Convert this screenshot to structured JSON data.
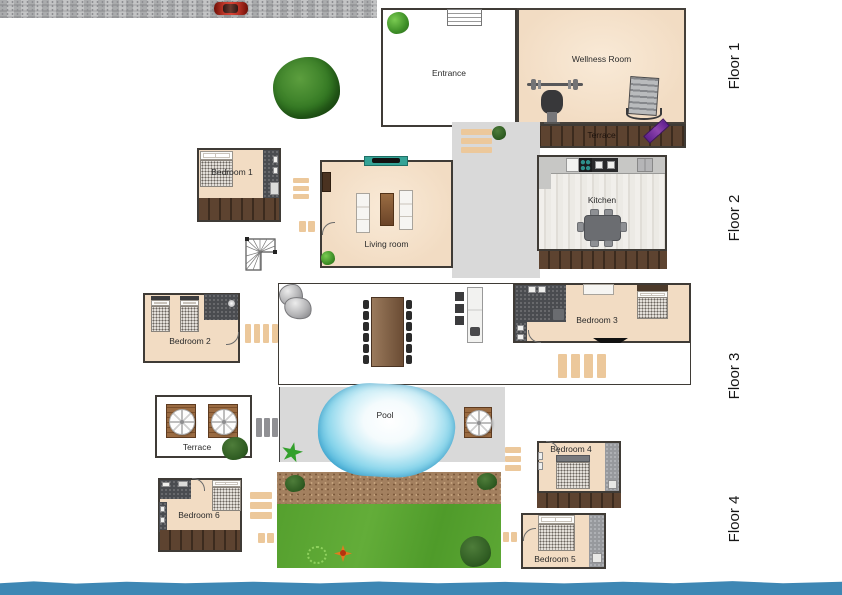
{
  "palette": {
    "room_fill": "#f2dcc3",
    "wall": "#3f3b36",
    "deck": "#5d4330",
    "deck_gap": "#3c2b1e",
    "gray_area": "#d9d9d9",
    "stair_tan": "#ecc89b",
    "water": "#3e87b4",
    "grass": "#58a430",
    "dirt": "#a3805f",
    "pool": "#49b4dc",
    "teal": "#35a396",
    "purple": "#7b2fa0"
  },
  "floors": [
    {
      "label": "Floor 1"
    },
    {
      "label": "Floor 2"
    },
    {
      "label": "Floor 3"
    },
    {
      "label": "Floor 4"
    }
  ],
  "rooms": {
    "entrance": "Entrance",
    "wellness": "Wellness Room",
    "terrace_floor1": "Terrace",
    "bedroom1": "Bedroom 1",
    "living": "Living room",
    "kitchen": "Kitchen",
    "bedroom2": "Bedroom 2",
    "bedroom3": "Bedroom 3",
    "pool": "Pool",
    "terrace_floor4": "Terrace",
    "bedroom4": "Bedroom 4",
    "bedroom5": "Bedroom 5",
    "bedroom6": "Bedroom 6"
  }
}
